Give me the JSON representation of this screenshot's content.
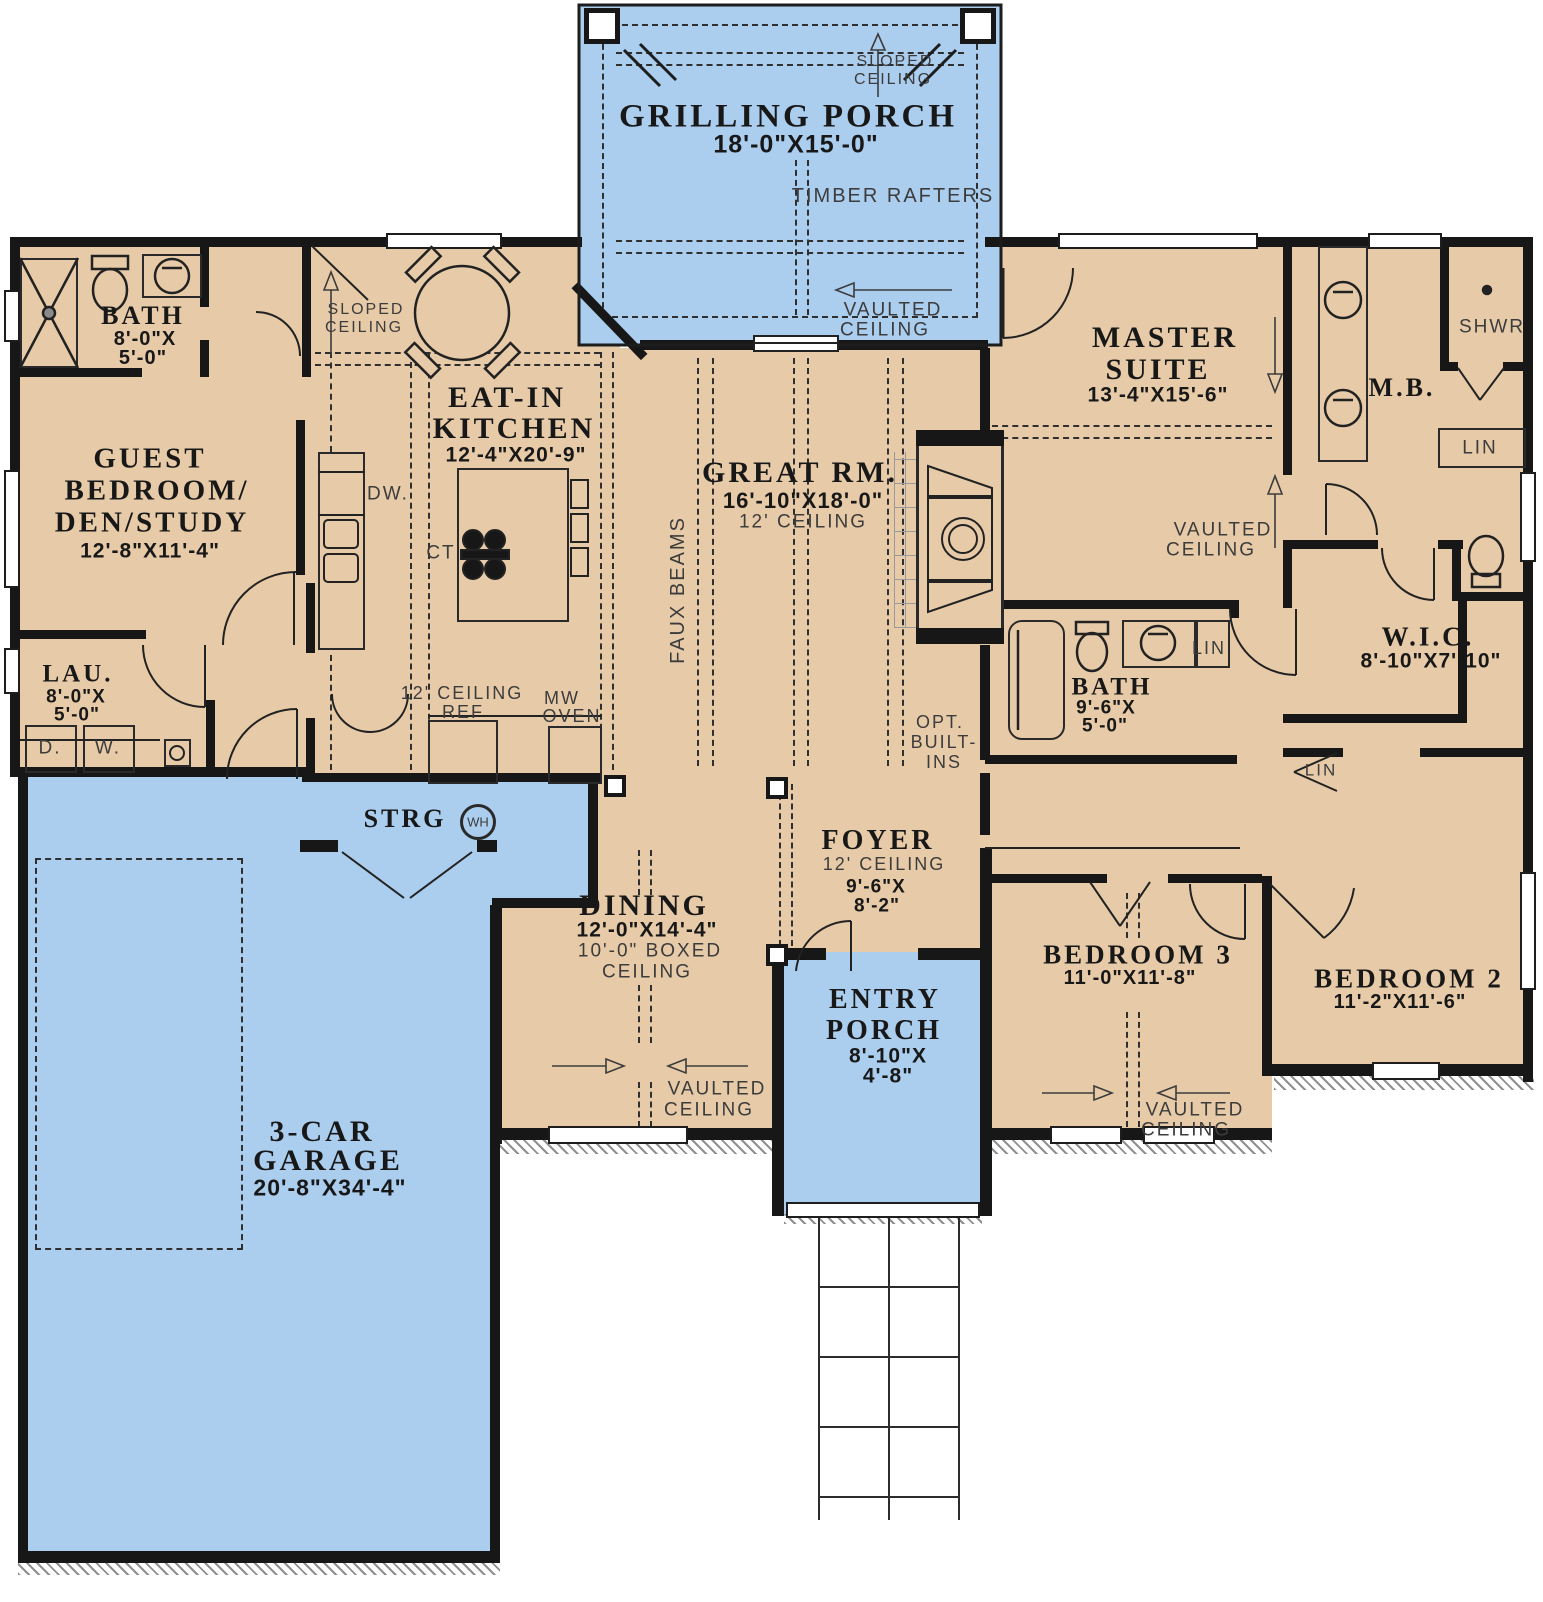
{
  "plan": {
    "colors": {
      "floor": "#e7cba8",
      "porch": "#abcdee",
      "wall": "#171717",
      "annotation": "#3c3c3c"
    },
    "rooms": {
      "grilling_porch": {
        "name": "GRILLING PORCH",
        "dims": "18'-0\"X15'-0\""
      },
      "bath1": {
        "name": "BATH",
        "dims1": "8'-0\"X",
        "dims2": "5'-0\""
      },
      "guest_bedroom": {
        "name1": "GUEST",
        "name2": "BEDROOM/",
        "name3": "DEN/STUDY",
        "dims": "12'-8\"X11'-4\""
      },
      "eat_in_kitchen": {
        "name1": "EAT-IN",
        "name2": "KITCHEN",
        "dims": "12'-4\"X20'-9\""
      },
      "great_room": {
        "name": "GREAT RM.",
        "dims": "16'-10\"X18'-0\"",
        "ceiling": "12' CEILING"
      },
      "master_suite": {
        "name1": "MASTER",
        "name2": "SUITE",
        "dims": "13'-4\"X15'-6\""
      },
      "master_bath": {
        "name": "M.B."
      },
      "wic": {
        "name": "W.I.C.",
        "dims": "8'-10\"X7'-10\""
      },
      "bath2": {
        "name": "BATH",
        "dims1": "9'-6\"X",
        "dims2": "5'-0\""
      },
      "laundry": {
        "name": "LAU.",
        "dims1": "8'-0\"X",
        "dims2": "5'-0\""
      },
      "storage": {
        "name": "STRG"
      },
      "dining": {
        "name": "DINING",
        "dims": "12'-0\"X14'-4\"",
        "ceiling1": "10'-0\" BOXED",
        "ceiling2": "CEILING"
      },
      "foyer": {
        "name": "FOYER",
        "ceiling": "12' CEILING",
        "dims1": "9'-6\"X",
        "dims2": "8'-2\""
      },
      "entry_porch": {
        "name1": "ENTRY",
        "name2": "PORCH",
        "dims1": "8'-10\"X",
        "dims2": "4'-8\""
      },
      "bedroom3": {
        "name": "BEDROOM 3",
        "dims": "11'-0\"X11'-8\""
      },
      "bedroom2": {
        "name": "BEDROOM 2",
        "dims": "11'-2\"X11'-6\""
      },
      "garage": {
        "name1": "3-CAR",
        "name2": "GARAGE",
        "dims": "20'-8\"X34'-4\""
      }
    },
    "annotations": {
      "sloped1": "SLOPED",
      "sloped2": "CEILING",
      "vaulted1": "VAULTED",
      "vaulted2": "CEILING",
      "timber_rafters": "TIMBER RAFTERS",
      "faux_beams": "FAUX BEAMS",
      "ceiling_12": "12' CEILING",
      "opt1": "OPT.",
      "opt2": "BUILT-",
      "opt3": "INS",
      "shwr": "SHWR",
      "lin": "LIN",
      "wh": "WH",
      "dw": "DW.",
      "ct": "CT",
      "ref": "REF",
      "mw1": "MW",
      "mw2": "OVEN",
      "dryer": "D.",
      "washer": "W."
    }
  }
}
